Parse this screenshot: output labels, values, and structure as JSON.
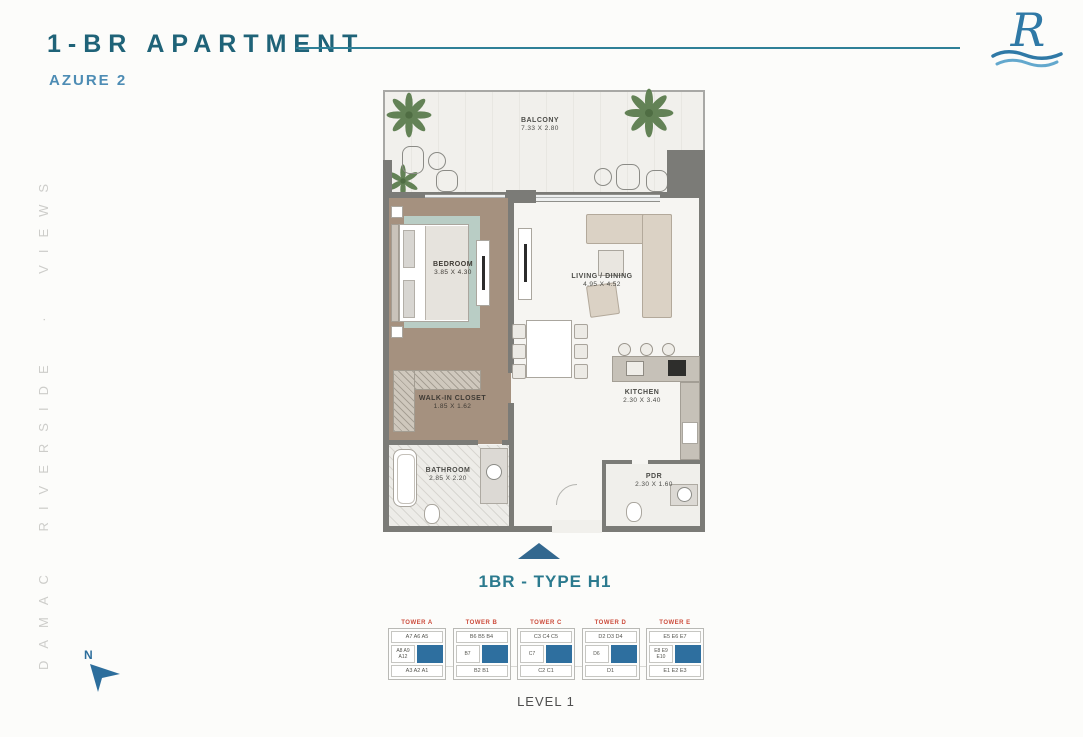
{
  "header": {
    "title": "1-BR APARTMENT",
    "subtitle": "AZURE 2"
  },
  "logo": {
    "letter": "R"
  },
  "watermark": {
    "text": "DAMAC RIVERSIDE · VIEWS"
  },
  "plan": {
    "rooms": {
      "balcony": {
        "name": "BALCONY",
        "dims": "7.33 X 2.80"
      },
      "bedroom": {
        "name": "BEDROOM",
        "dims": "3.85 X 4.30"
      },
      "living": {
        "name": "LIVING / DINING",
        "dims": "4.95 X 4.52"
      },
      "closet": {
        "name": "WALK-IN CLOSET",
        "dims": "1.85 X 1.62"
      },
      "kitchen": {
        "name": "KITCHEN",
        "dims": "2.30 X 3.40"
      },
      "bathroom": {
        "name": "BATHROOM",
        "dims": "2.85 X 2.20"
      },
      "pdr": {
        "name": "PDR",
        "dims": "2.30 X 1.60"
      }
    },
    "type_label": "1BR - TYPE H1"
  },
  "keyplan": {
    "level_label": "LEVEL 1",
    "towers": [
      {
        "name": "TOWER A",
        "top_units": "A7 A6 A5",
        "side_units": "A8 A9 A12",
        "bottom_units": "A3 A2 A1"
      },
      {
        "name": "TOWER B",
        "top_units": "B6 B5 B4",
        "side_units": "B7",
        "bottom_units": "B2 B1"
      },
      {
        "name": "TOWER C",
        "top_units": "C3 C4 C5",
        "side_units": "C7",
        "bottom_units": "C2 C1"
      },
      {
        "name": "TOWER D",
        "top_units": "D2 D3 D4",
        "side_units": "D6",
        "bottom_units": "D1"
      },
      {
        "name": "TOWER E",
        "top_units": "E5 E6 E7",
        "side_units": "E8 E9 E10",
        "bottom_units": "E1 E2 E3"
      }
    ]
  },
  "compass": {
    "label": "N"
  },
  "colors": {
    "accent_teal": "#1f6378",
    "accent_blue": "#4d8cb4",
    "tower_red": "#cc4b3b",
    "highlight_blue": "#2e6f9f",
    "wall_gray": "#7b7b77"
  }
}
